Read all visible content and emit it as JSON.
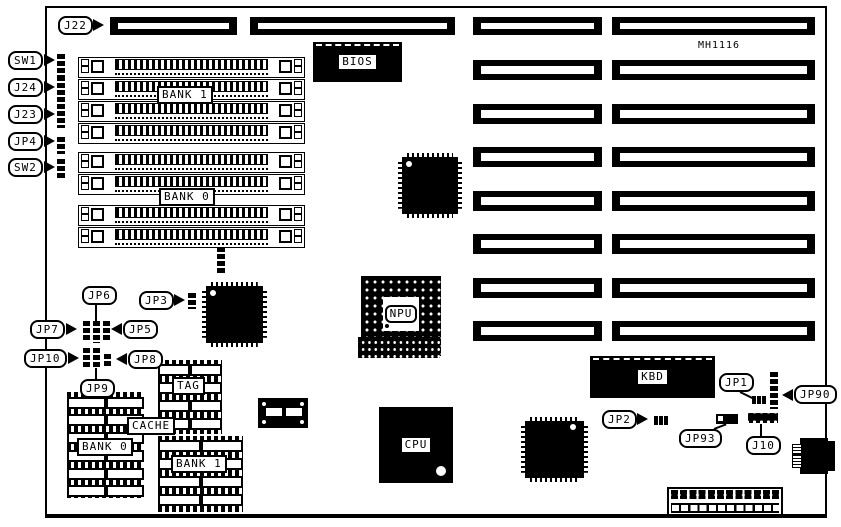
{
  "diagram": {
    "part_number": "MH1116",
    "colors": {
      "ink": "#000000",
      "paper": "#ffffff"
    },
    "chips": {
      "bios": "BIOS",
      "npu": "NPU",
      "cpu": "CPU",
      "kbd": "KBD"
    },
    "memory": {
      "simm_bank1": "BANK 1",
      "simm_bank0": "BANK 0",
      "cache": "CACHE",
      "tag": "TAG",
      "cache_bank0": "BANK 0",
      "cache_bank1": "BANK 1"
    },
    "callouts": {
      "j22": "J22",
      "sw1": "SW1",
      "j24": "J24",
      "j23": "J23",
      "jp4": "JP4",
      "sw2": "SW2",
      "jp6": "JP6",
      "jp3": "JP3",
      "jp7": "JP7",
      "jp5": "JP5",
      "jp10": "JP10",
      "jp8": "JP8",
      "jp9": "JP9",
      "jp1": "JP1",
      "jp90": "JP90",
      "jp2": "JP2",
      "jp93": "JP93",
      "j10": "J10"
    }
  }
}
